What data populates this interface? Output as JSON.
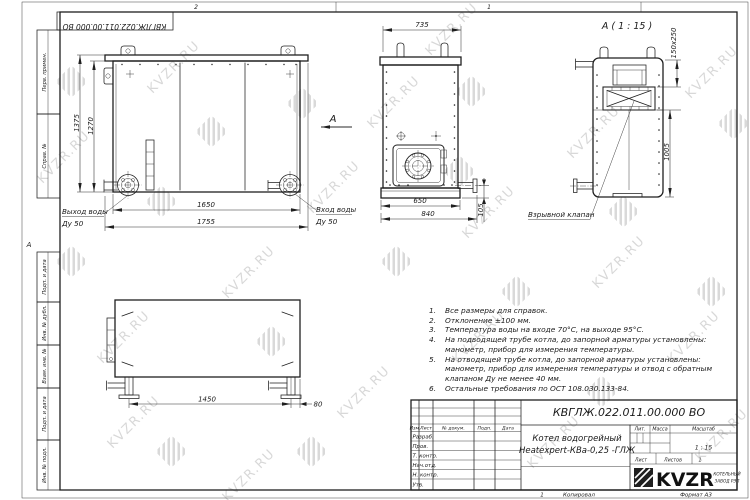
{
  "watermark": {
    "text": "KVZR.RU"
  },
  "frame": {
    "zone_1": "1",
    "zone_2": "2",
    "zone_a": "А",
    "side_fields": [
      "Перв. примен.",
      "Справ. №",
      "Подп. и дата",
      "Инв. № дубл.",
      "Взам. инв. №",
      "Подп. и дата",
      "Инв. № подл."
    ]
  },
  "views": {
    "front": {
      "dim_height_outer": "1375",
      "dim_height_inner": "1270",
      "dim_width_inner": "1650",
      "dim_width_outer": "1755",
      "label_outlet": "Выход воды",
      "label_outlet_size": "Ду 50",
      "label_inlet": "Вход воды",
      "label_inlet_size": "Ду 50",
      "view_arrow_label": "А"
    },
    "top": {
      "dim_width": "735",
      "dim_base": "650",
      "dim_base_outer": "840",
      "dim_pipe": "105",
      "label_valve": "Взрывной клапан"
    },
    "detail": {
      "title": "А ( 1 : 15 )",
      "dim_valve": "150x250",
      "dim_height": "1005"
    },
    "side": {
      "dim_span": "1450",
      "dim_offset": "80"
    }
  },
  "notes": [
    {
      "num": "1.",
      "lines": [
        "Все размеры для справок."
      ]
    },
    {
      "num": "2.",
      "lines": [
        "Отклонение ±100 мм."
      ]
    },
    {
      "num": "3.",
      "lines": [
        "Температура воды на входе 70°С, на выходе 95°С."
      ]
    },
    {
      "num": "4.",
      "lines": [
        "На подводящей трубе котла, до запорной арматуры установлены:",
        "манометр, прибор для измерения температуры."
      ]
    },
    {
      "num": "5.",
      "lines": [
        "На отводящей трубе котла, до запорной арматуры установлены:",
        "манометр, прибор для измерения температуры и отвод с обратным",
        "клапаном Ду не менее 40 мм."
      ]
    },
    {
      "num": "6.",
      "lines": [
        "Остальные требования по ОСТ 108.030.133-84."
      ]
    }
  ],
  "title_block": {
    "doc_number": "КВГЛЖ.022.011.00.000 ВО",
    "product_name_1": "Котел водогрейный",
    "product_name_2": "Heatexpert-КВа-0,25 -ГЛЖ",
    "col_izm": "Изм.",
    "col_list": "Лист",
    "col_doc": "№ докум.",
    "col_podp": "Подп.",
    "col_data": "Дата",
    "rows": [
      "Разраб.",
      "Пров.",
      "Т. контр.",
      "Нач.отд.",
      "Н. контр.",
      "Утв."
    ],
    "lit_label": "Лит.",
    "mass_label": "Масса",
    "scale_label": "Масштаб",
    "scale_value": "1 : 15",
    "sheet_label": "Лист",
    "sheets_label": "Листов",
    "sheets_value": "1",
    "logo_text": "KVZR",
    "logo_sub_1": "КОТЕЛЬНЫЙ",
    "logo_sub_2": "ЗАВОД РЭП"
  },
  "bottom_strip": {
    "num": "1",
    "copied": "Копировал",
    "format": "Формат А3"
  }
}
